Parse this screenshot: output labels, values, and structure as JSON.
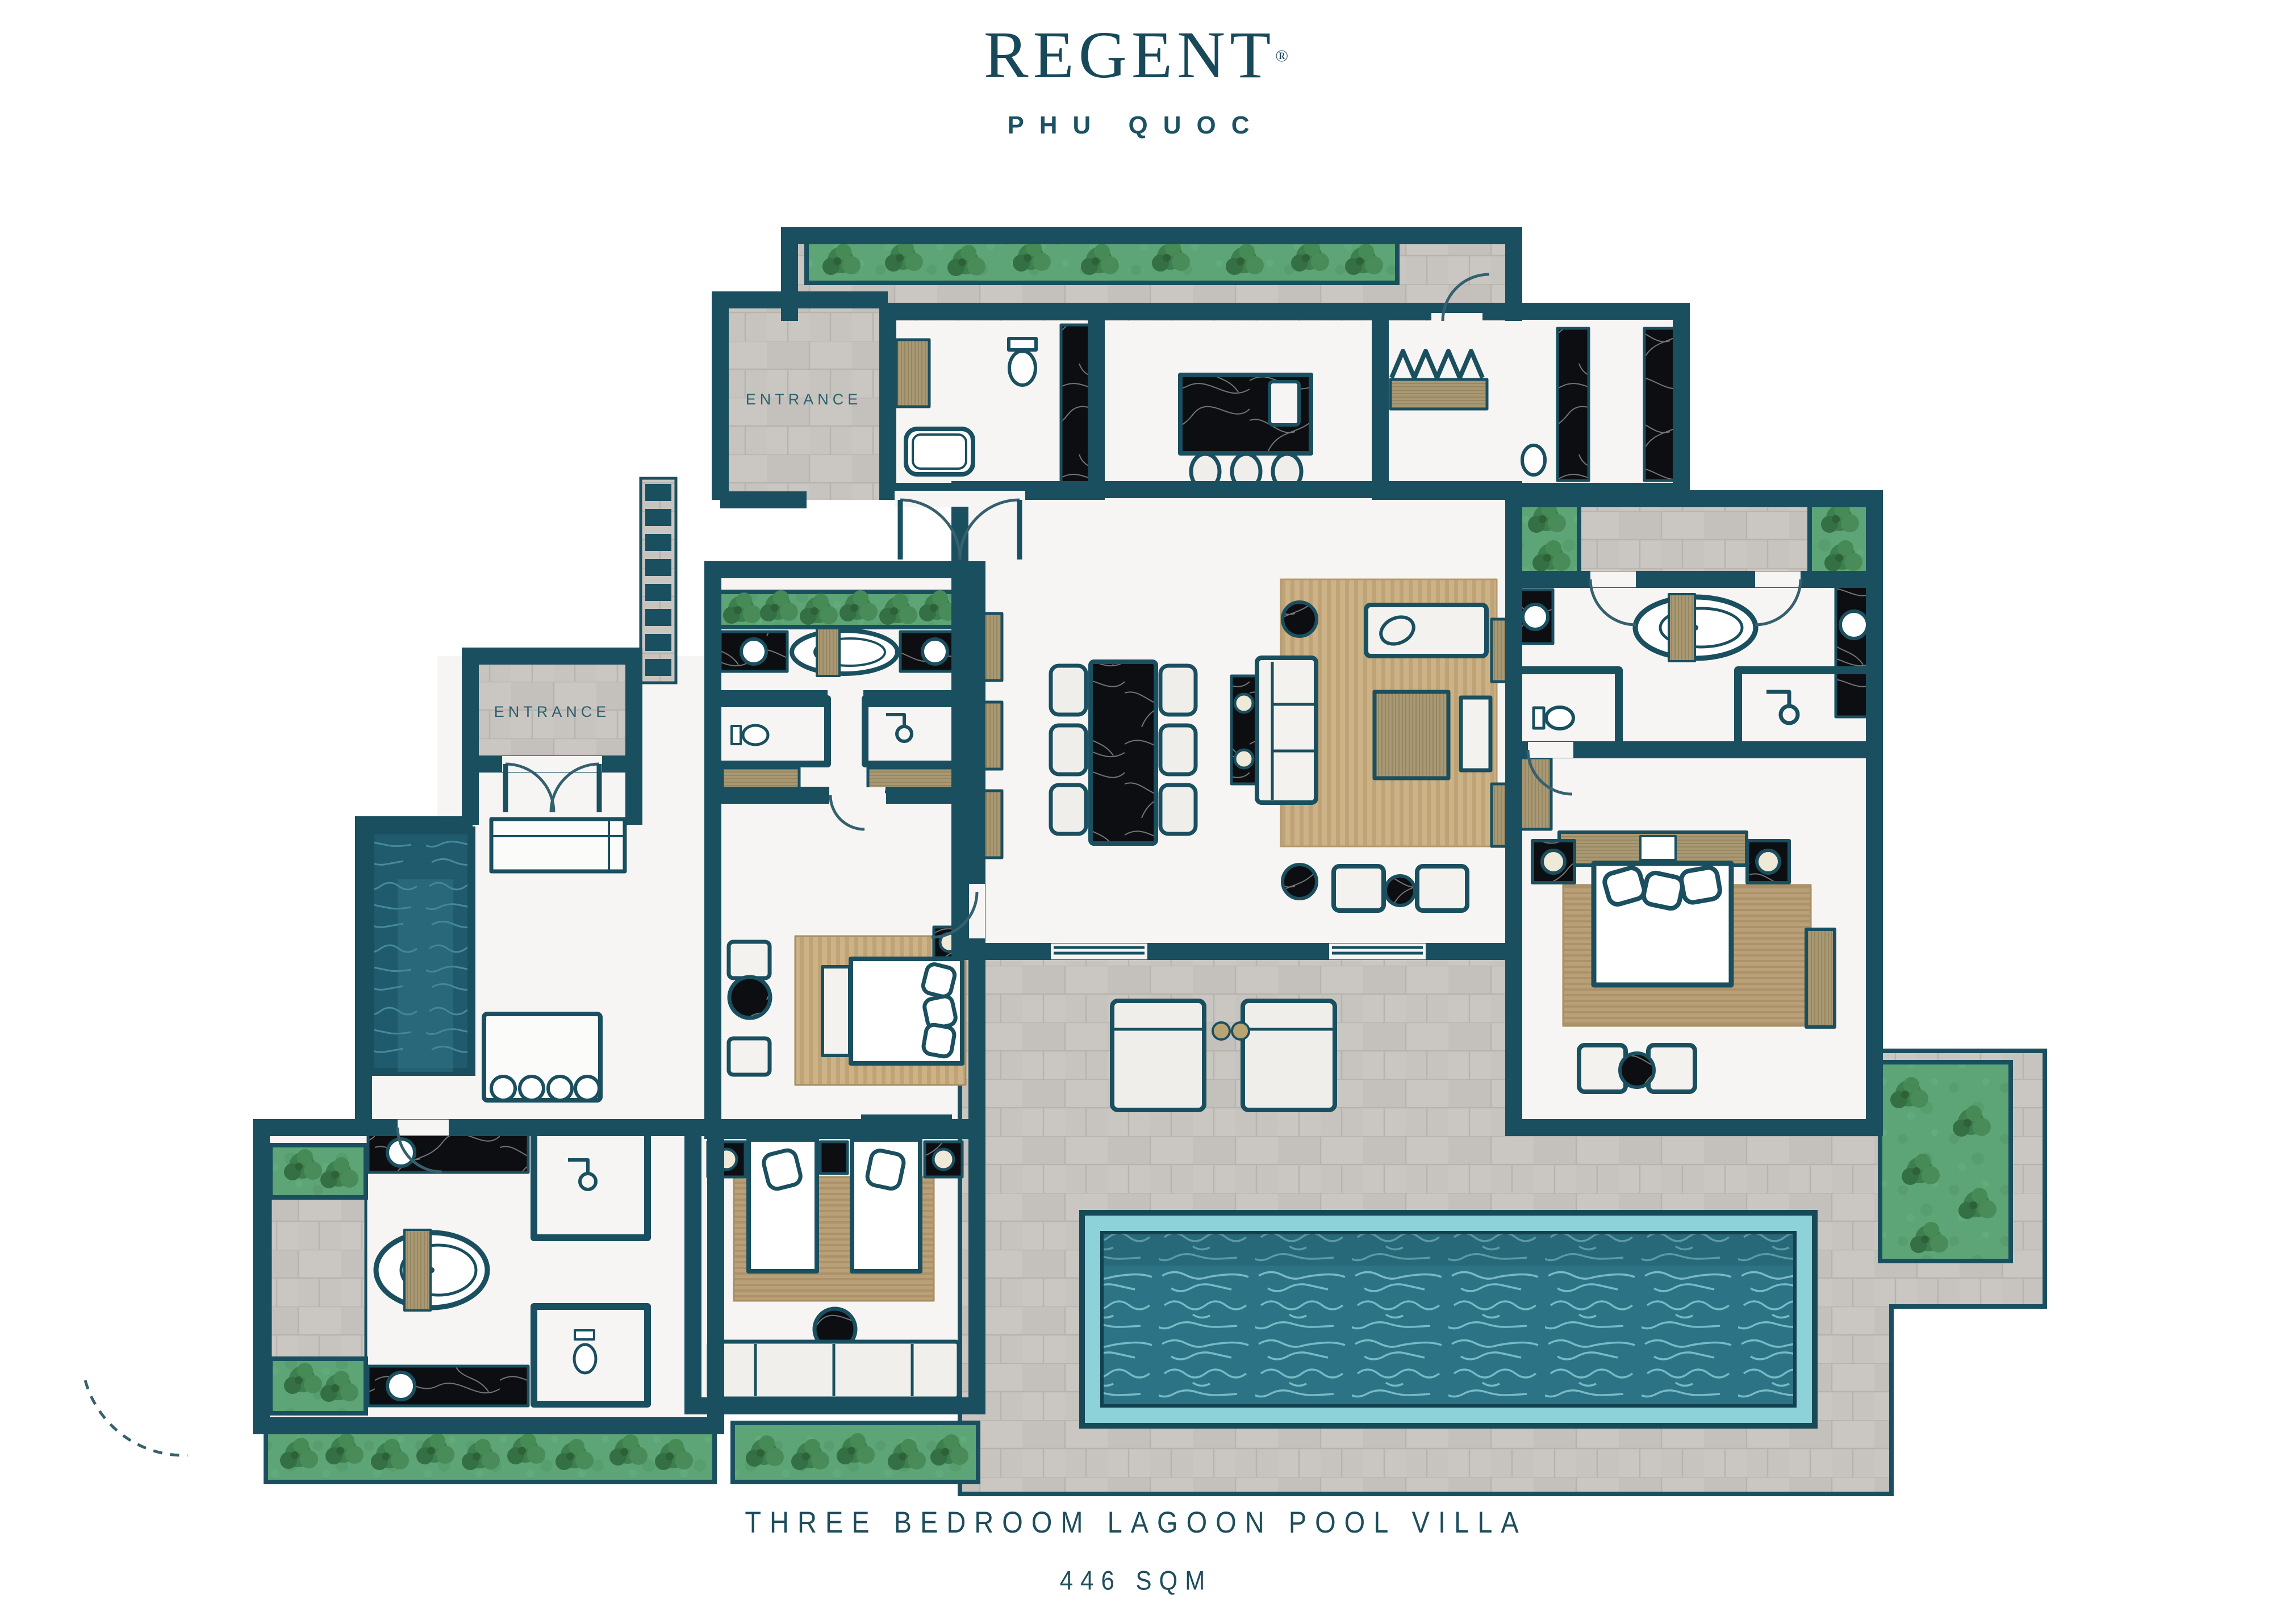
{
  "brand": {
    "name": "REGENT",
    "registered": "®",
    "location": "PHU QUOC"
  },
  "plan": {
    "entrance_upper": "ENTRANCE",
    "entrance_lower": "ENTRANCE"
  },
  "footer": {
    "title": "THREE BEDROOM LAGOON POOL VILLA",
    "area": "446 SQM"
  },
  "colors": {
    "brand_teal": "#17495a",
    "wall": "#1a4f5f",
    "floor_white": "#f6f5f3",
    "stone_tile": "#cac7c3",
    "grass": "#5da476",
    "tree": "#3e7f4f",
    "pool_water": "#2d7386",
    "pool_rim": "#8ed2d9",
    "lagoon_water": "#1f5a6d",
    "rug_tan": "#c8ad80",
    "wood": "#a89873",
    "marble_black": "#0d0e12",
    "furniture_white": "#efeeea"
  }
}
